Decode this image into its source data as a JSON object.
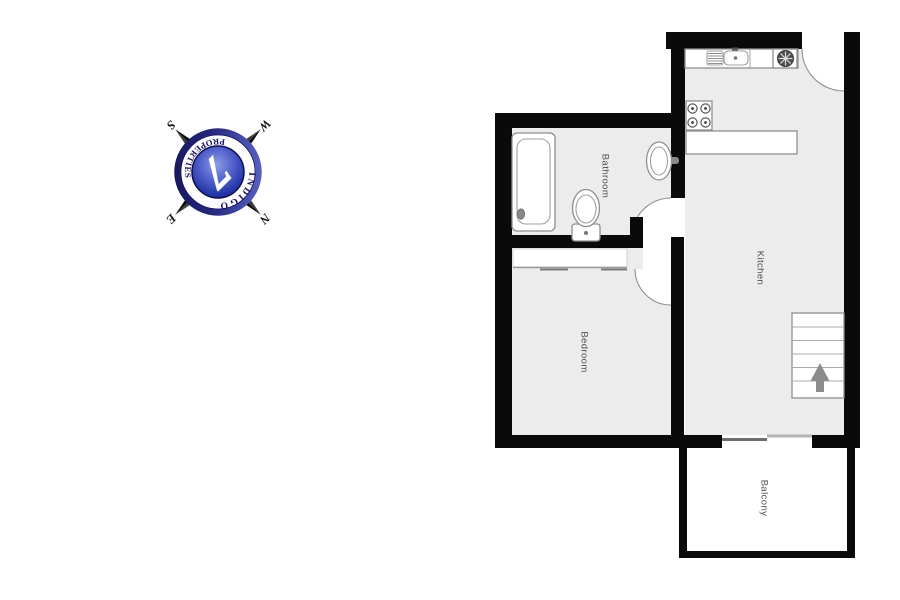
{
  "logo": {
    "brand_arc_top": "INDIGO",
    "brand_arc_bottom": "PROPERTIES",
    "monogram": "7",
    "rotation_deg": 135,
    "compass_points": {
      "n": "N",
      "e": "E",
      "s": "S",
      "w": "W"
    },
    "colors": {
      "navy": "#151065",
      "disc_blue": "#4a5cc4",
      "band": "#ffffff",
      "star_dark": "#0c0c0c",
      "star_light": "#3f3f3f"
    }
  },
  "floorplan": {
    "rooms": [
      {
        "id": "bathroom",
        "name": "Bathroom"
      },
      {
        "id": "kitchen",
        "name": "Kitchen"
      },
      {
        "id": "bedroom",
        "name": "Bedroom"
      },
      {
        "id": "balcony",
        "name": "Balcony"
      }
    ],
    "stairs": {
      "treads": 6,
      "direction_arrow": "up"
    },
    "fixtures": [
      "bathtub",
      "toilet",
      "bathroom-sink",
      "kitchen-sink",
      "drainer",
      "extractor-fan",
      "stove-4-burner",
      "kitchen-counter",
      "island-counter",
      "wardrobe",
      "sliding-balcony-door",
      "stairs"
    ],
    "colors": {
      "wall": "#0a0a0a",
      "floor": "#ececec",
      "fixture_stroke": "#8f8f8f",
      "label": "#4d4d4d",
      "arrow": "#8c8c8c"
    }
  }
}
